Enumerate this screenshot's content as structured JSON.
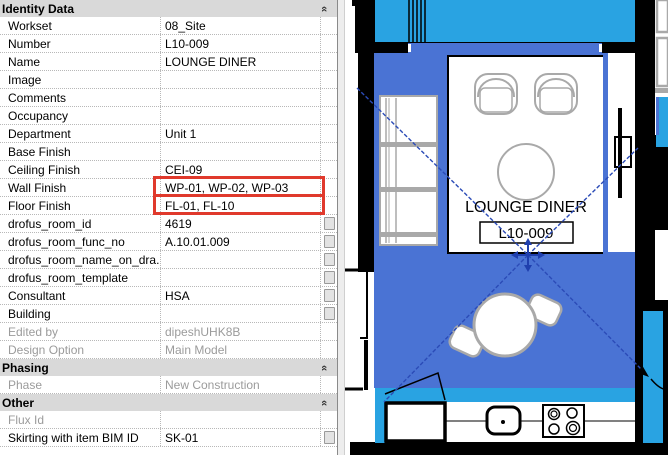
{
  "properties_panel": {
    "sections": [
      {
        "label": "Identity Data",
        "rows": [
          {
            "label": "Workset",
            "value": "08_Site",
            "disabled": false,
            "button": false,
            "highlight": false
          },
          {
            "label": "Number",
            "value": "L10-009",
            "disabled": false,
            "button": false,
            "highlight": false
          },
          {
            "label": "Name",
            "value": "LOUNGE DINER",
            "disabled": false,
            "button": false,
            "highlight": false
          },
          {
            "label": "Image",
            "value": "",
            "disabled": false,
            "button": false,
            "highlight": false
          },
          {
            "label": "Comments",
            "value": "",
            "disabled": false,
            "button": false,
            "highlight": false
          },
          {
            "label": "Occupancy",
            "value": "",
            "disabled": false,
            "button": false,
            "highlight": false
          },
          {
            "label": "Department",
            "value": "Unit 1",
            "disabled": false,
            "button": false,
            "highlight": false
          },
          {
            "label": "Base Finish",
            "value": "",
            "disabled": false,
            "button": false,
            "highlight": false
          },
          {
            "label": "Ceiling Finish",
            "value": "CEI-09",
            "disabled": false,
            "button": false,
            "highlight": false
          },
          {
            "label": "Wall Finish",
            "value": "WP-01, WP-02, WP-03",
            "disabled": false,
            "button": false,
            "highlight": true
          },
          {
            "label": "Floor Finish",
            "value": "FL-01, FL-10",
            "disabled": false,
            "button": false,
            "highlight": true
          },
          {
            "label": "drofus_room_id",
            "value": "4619",
            "disabled": false,
            "button": true,
            "highlight": false
          },
          {
            "label": "drofus_room_func_no",
            "value": "A.10.01.009",
            "disabled": false,
            "button": true,
            "highlight": false
          },
          {
            "label": "drofus_room_name_on_dra...",
            "value": "",
            "disabled": false,
            "button": true,
            "highlight": false
          },
          {
            "label": "drofus_room_template",
            "value": "",
            "disabled": false,
            "button": true,
            "highlight": false
          },
          {
            "label": "Consultant",
            "value": "HSA",
            "disabled": false,
            "button": true,
            "highlight": false
          },
          {
            "label": "Building",
            "value": "",
            "disabled": false,
            "button": true,
            "highlight": false
          },
          {
            "label": "Edited by",
            "value": "dipeshUHK8B",
            "disabled": true,
            "button": false,
            "highlight": false
          },
          {
            "label": "Design Option",
            "value": "Main Model",
            "disabled": true,
            "button": false,
            "highlight": false
          }
        ]
      },
      {
        "label": "Phasing",
        "rows": [
          {
            "label": "Phase",
            "value": "New Construction",
            "disabled": true,
            "button": false,
            "highlight": false
          }
        ]
      },
      {
        "label": "Other",
        "rows": [
          {
            "label": "Flux Id",
            "value": "",
            "disabled": true,
            "button": false,
            "highlight": false
          },
          {
            "label": "Skirting with item BIM ID",
            "value": "SK-01",
            "disabled": false,
            "button": true,
            "highlight": false
          }
        ]
      }
    ],
    "collapse_icon": "«"
  },
  "plan": {
    "room_name": "LOUNGE DINER",
    "room_number": "L10-009"
  },
  "colors": {
    "header-gray": "#d9d9d9",
    "disabled-gray": "#9b9b9b",
    "highlight-red": "#e0392c",
    "room-blue": "#4a73d4",
    "cyan": "#29a3e2",
    "diagonal-blue": "#2b4bb7",
    "crosshair-blue": "#1f3fae",
    "furniture-gray": "#a9a9a9",
    "wall-black": "#000000"
  }
}
